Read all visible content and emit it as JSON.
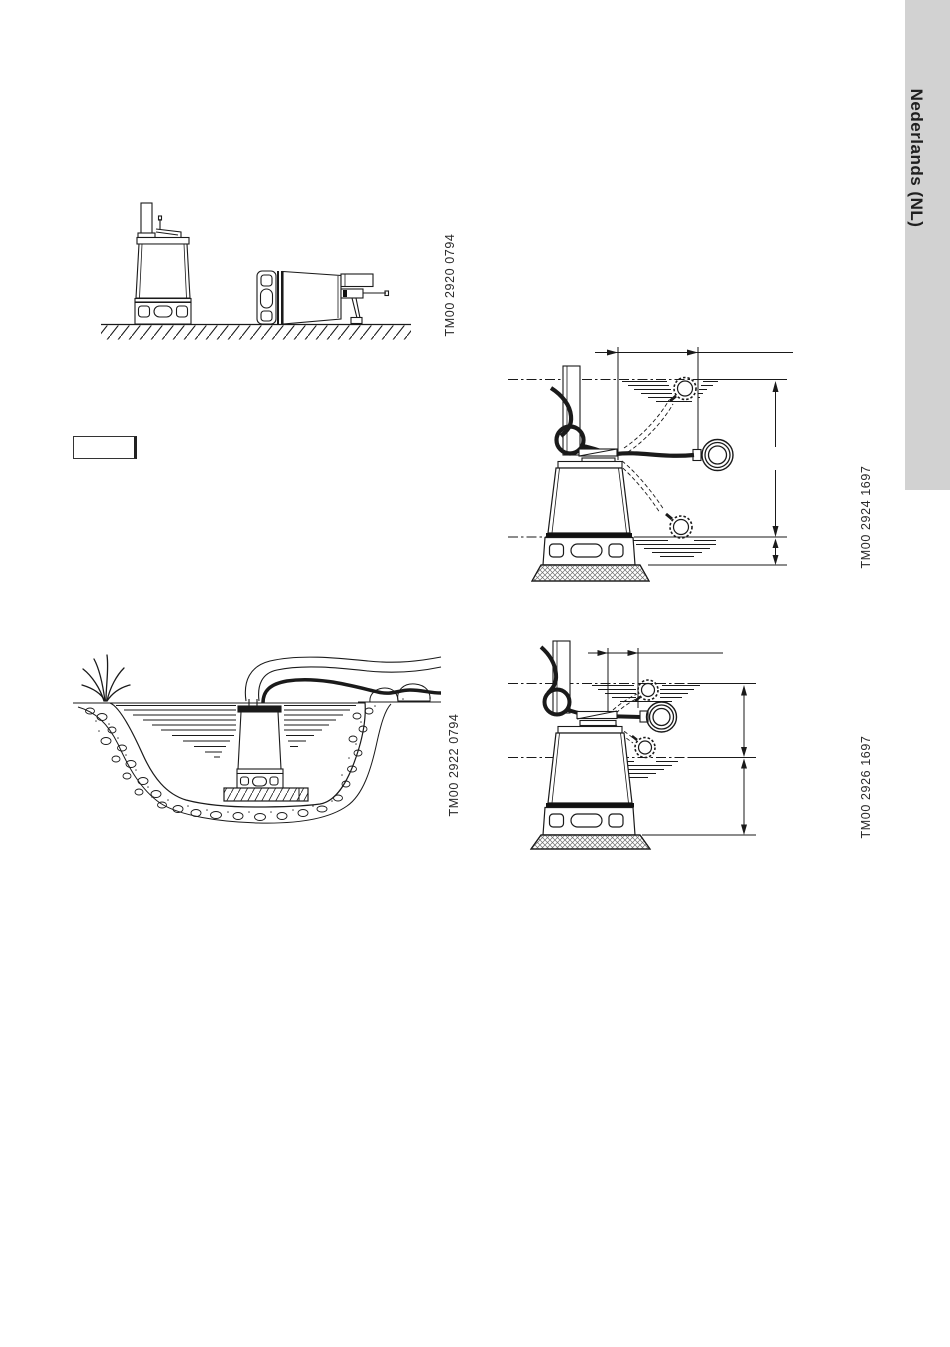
{
  "sidebar": {
    "label": "Nederlands (NL)",
    "background": "#d2d2d2"
  },
  "figures": [
    {
      "id": "pump-orientations",
      "code": "TM00 2920 0794"
    },
    {
      "id": "pit-installation",
      "code": "TM00 2922 0794"
    },
    {
      "id": "float-switch-long-tether",
      "code": "TM00 2924 1697"
    },
    {
      "id": "float-switch-short-tether",
      "code": "TM00 2926 1697"
    }
  ],
  "note_box": {
    "text": ""
  }
}
